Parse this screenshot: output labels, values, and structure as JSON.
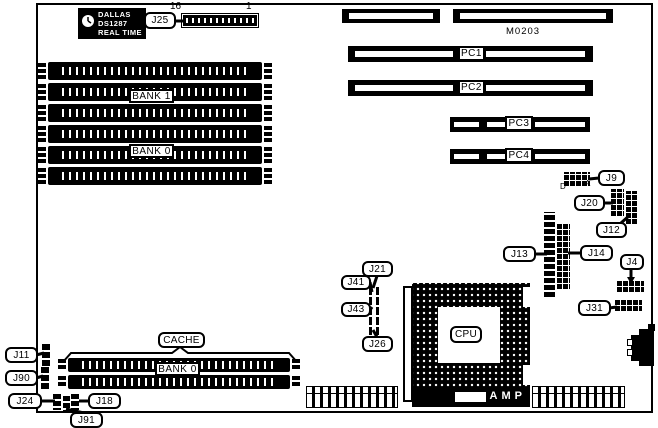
{
  "diagram": {
    "model": "M0203",
    "rtc_chip": {
      "brand": "DALLAS",
      "part": "DS1287",
      "type": "REAL TIME"
    },
    "j25_header": {
      "pin_high": "16",
      "pin_low": "1"
    },
    "memory_banks": {
      "bank1": "BANK 1",
      "bank0": "BANK 0"
    },
    "cache": {
      "title": "CACHE",
      "bank": "BANK 0"
    },
    "expansion_slots": {
      "pc1": "PC1",
      "pc2": "PC2",
      "pc3": "PC3",
      "pc4": "PC4"
    },
    "cpu": {
      "label": "CPU",
      "socket_brand": "AMP"
    },
    "pin_markers": {
      "d": "D",
      "a": "A"
    },
    "jumper_labels": {
      "j25": "J25",
      "j9": "J9",
      "j20": "J20",
      "j12": "J12",
      "j13": "J13",
      "j14": "J14",
      "j4": "J4",
      "j31": "J31",
      "j21": "J21",
      "j41": "J41",
      "j43": "J43",
      "j26": "J26",
      "j11": "J11",
      "j90": "J90",
      "j24": "J24",
      "j18": "J18",
      "j91": "J91"
    },
    "colors": {
      "ink": "#000000",
      "paper": "#ffffff"
    }
  }
}
